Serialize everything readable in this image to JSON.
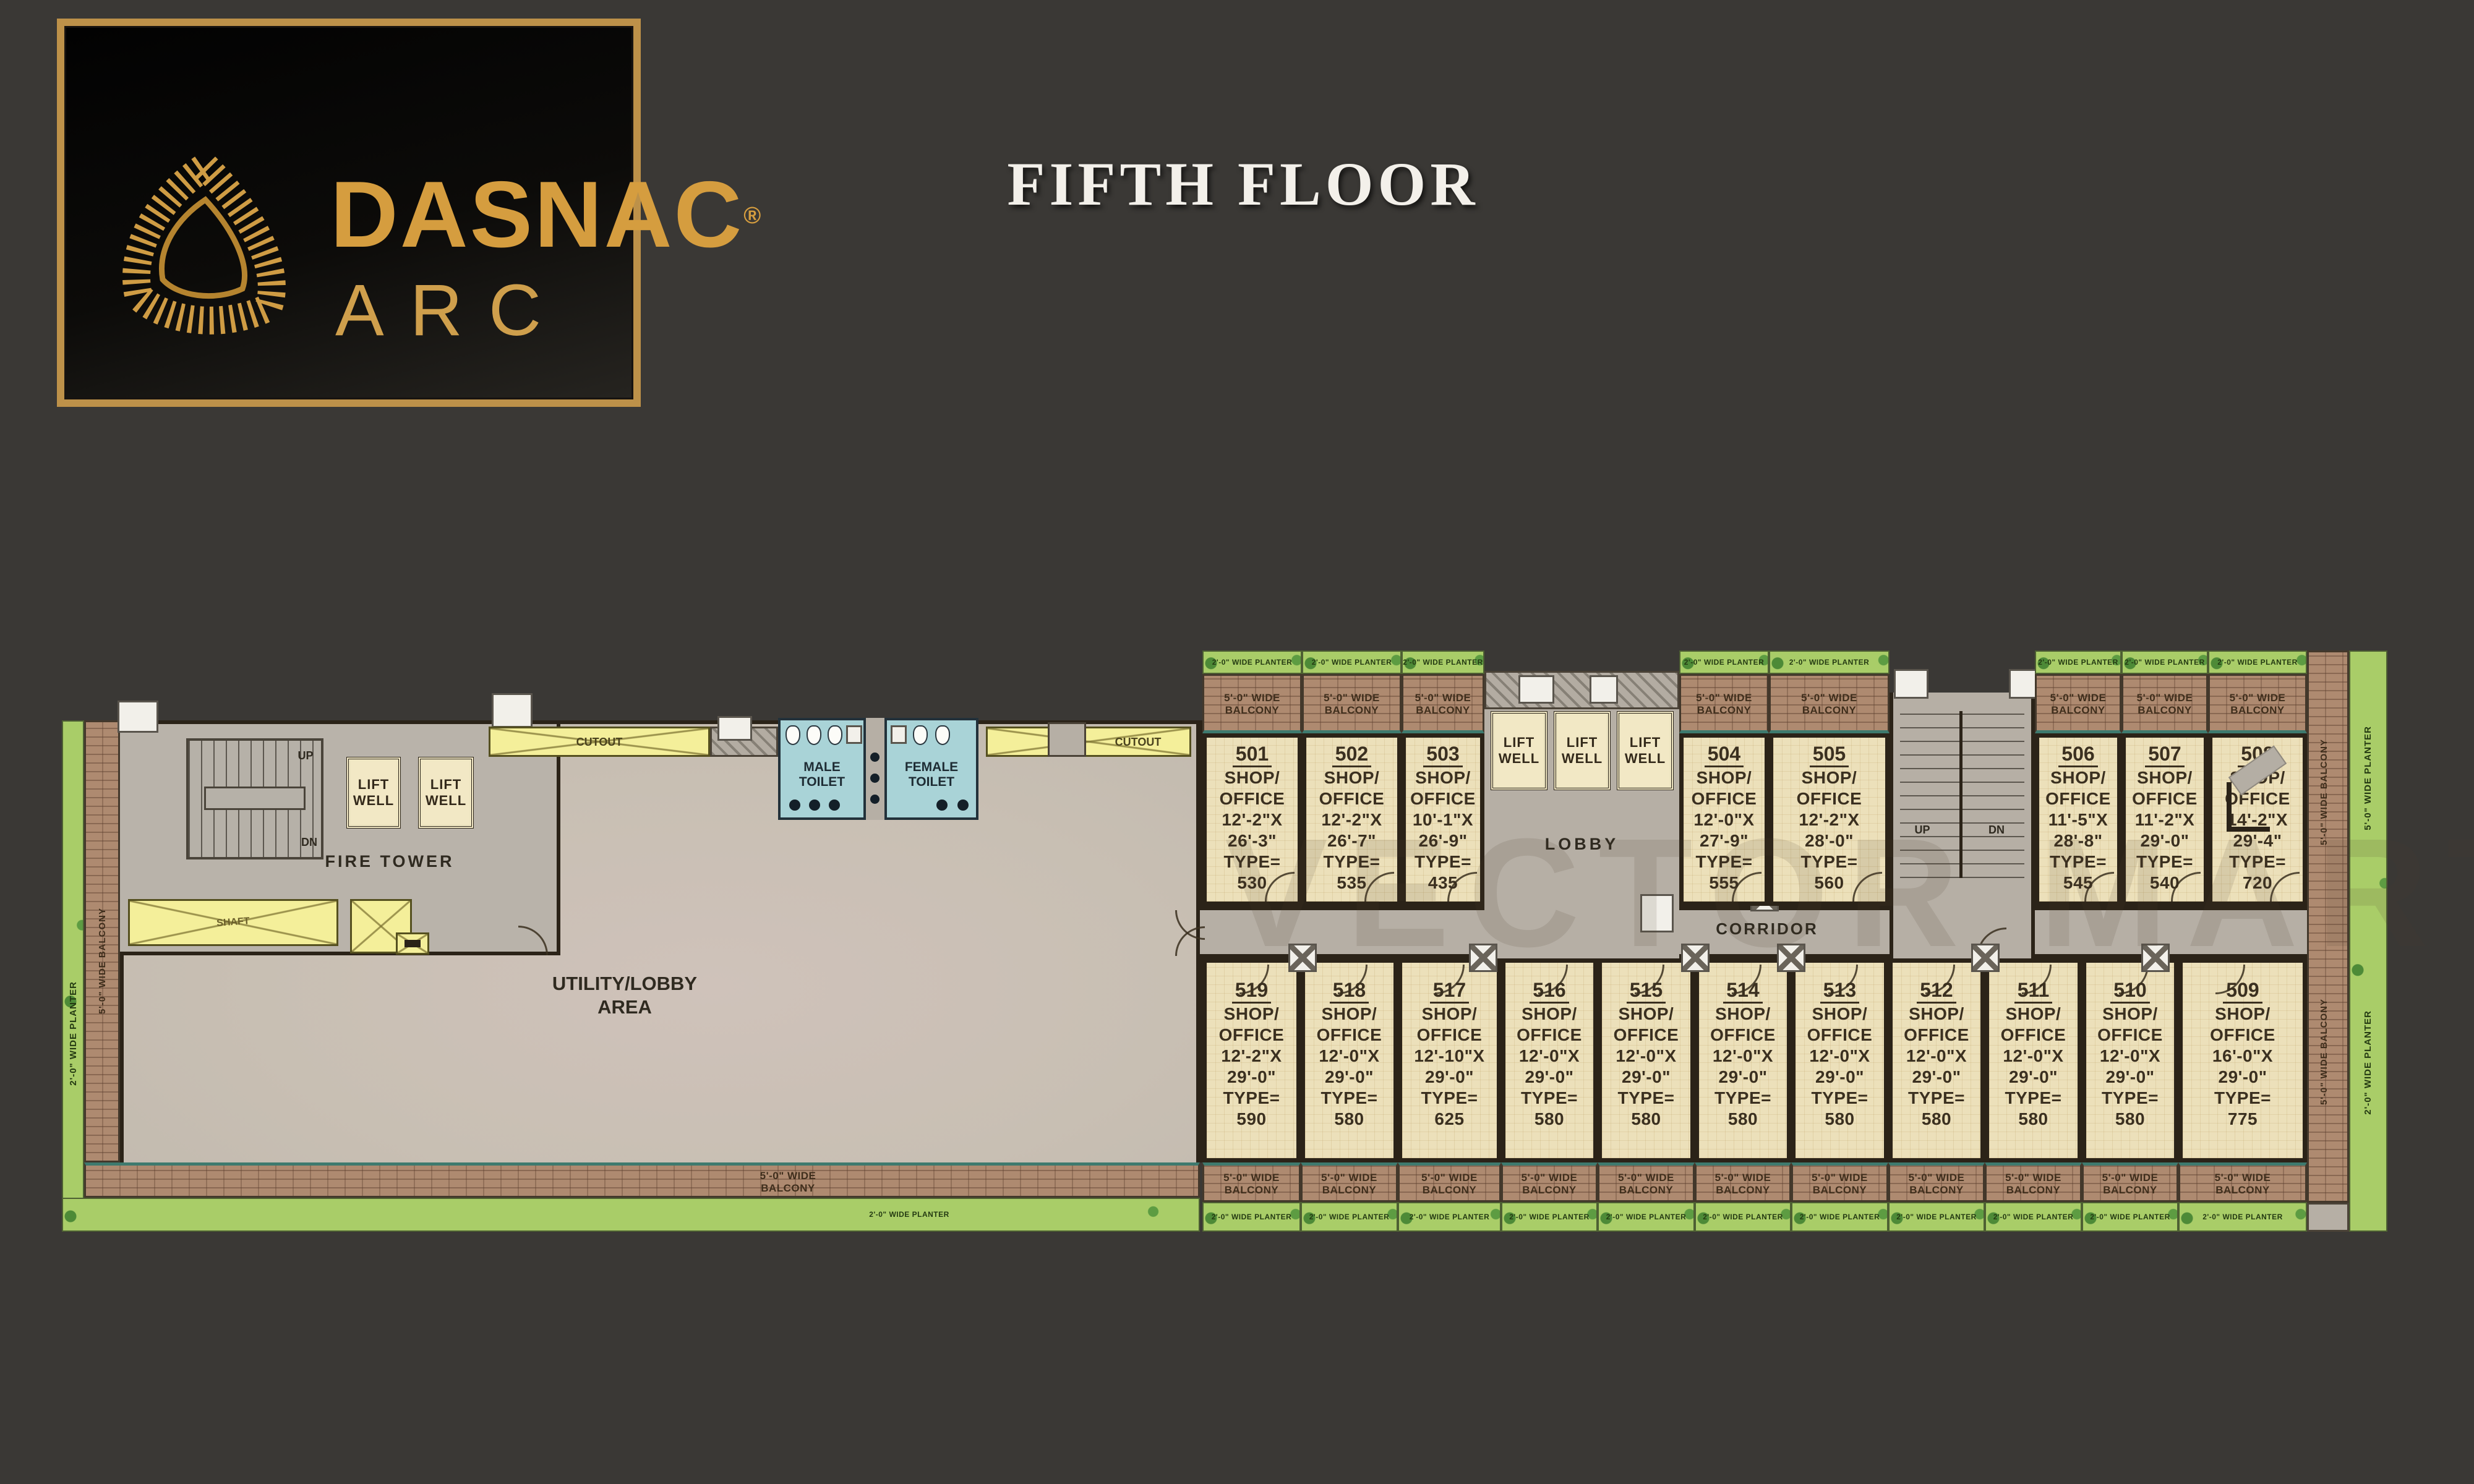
{
  "page": {
    "title": "FIFTH FLOOR"
  },
  "logo": {
    "brand": "DASNAC",
    "reg": "®",
    "sub": "ARC"
  },
  "watermark": "VECTOR MART",
  "labels": {
    "corridor": "CORRIDOR",
    "lobby": "LOBBY",
    "fire_tower": "FIRE TOWER",
    "utility1": "UTILITY/LOBBY",
    "utility2": "AREA",
    "lift1": "LIFT",
    "lift2": "WELL",
    "male1": "MALE",
    "male2": "TOILET",
    "female1": "FEMALE",
    "female2": "TOILET",
    "cutout": "CUTOUT",
    "shaft": "SHAFT",
    "up": "UP",
    "dn": "DN",
    "balcony5_l1": "5'-0\" WIDE",
    "balcony5_l2": "BALCONY",
    "balcony5_vert": "5'-0\" WIDE BALCONY",
    "planter2": "2'-0\" WIDE PLANTER",
    "planter5": "5'-0\" WIDE PLANTER"
  },
  "units": {
    "top": [
      {
        "no": "501",
        "l1": "SHOP/",
        "l2": "OFFICE",
        "d1": "12'-2\"X",
        "d2": "26'-3\"",
        "t": "TYPE=",
        "a": "530"
      },
      {
        "no": "502",
        "l1": "SHOP/",
        "l2": "OFFICE",
        "d1": "12'-2\"X",
        "d2": "26'-7\"",
        "t": "TYPE=",
        "a": "535"
      },
      {
        "no": "503",
        "l1": "SHOP/",
        "l2": "OFFICE",
        "d1": "10'-1\"X",
        "d2": "26'-9\"",
        "t": "TYPE=",
        "a": "435"
      },
      {
        "no": "504",
        "l1": "SHOP/",
        "l2": "OFFICE",
        "d1": "12'-0\"X",
        "d2": "27'-9\"",
        "t": "TYPE=",
        "a": "555"
      },
      {
        "no": "505",
        "l1": "SHOP/",
        "l2": "OFFICE",
        "d1": "12'-2\"X",
        "d2": "28'-0\"",
        "t": "TYPE=",
        "a": "560"
      },
      {
        "no": "506",
        "l1": "SHOP/",
        "l2": "OFFICE",
        "d1": "11'-5\"X",
        "d2": "28'-8\"",
        "t": "TYPE=",
        "a": "545"
      },
      {
        "no": "507",
        "l1": "SHOP/",
        "l2": "OFFICE",
        "d1": "11'-2\"X",
        "d2": "29'-0\"",
        "t": "TYPE=",
        "a": "540"
      },
      {
        "no": "508",
        "l1": "SHOP/",
        "l2": "OFFICE",
        "d1": "14'-2\"X",
        "d2": "29'-4\"",
        "t": "TYPE=",
        "a": "720"
      }
    ],
    "bottom": [
      {
        "no": "519",
        "l1": "SHOP/",
        "l2": "OFFICE",
        "d1": "12'-2\"X",
        "d2": "29'-0\"",
        "t": "TYPE=",
        "a": "590"
      },
      {
        "no": "518",
        "l1": "SHOP/",
        "l2": "OFFICE",
        "d1": "12'-0\"X",
        "d2": "29'-0\"",
        "t": "TYPE=",
        "a": "580"
      },
      {
        "no": "517",
        "l1": "SHOP/",
        "l2": "OFFICE",
        "d1": "12'-10\"X",
        "d2": "29'-0\"",
        "t": "TYPE=",
        "a": "625"
      },
      {
        "no": "516",
        "l1": "SHOP/",
        "l2": "OFFICE",
        "d1": "12'-0\"X",
        "d2": "29'-0\"",
        "t": "TYPE=",
        "a": "580"
      },
      {
        "no": "515",
        "l1": "SHOP/",
        "l2": "OFFICE",
        "d1": "12'-0\"X",
        "d2": "29'-0\"",
        "t": "TYPE=",
        "a": "580"
      },
      {
        "no": "514",
        "l1": "SHOP/",
        "l2": "OFFICE",
        "d1": "12'-0\"X",
        "d2": "29'-0\"",
        "t": "TYPE=",
        "a": "580"
      },
      {
        "no": "513",
        "l1": "SHOP/",
        "l2": "OFFICE",
        "d1": "12'-0\"X",
        "d2": "29'-0\"",
        "t": "TYPE=",
        "a": "580"
      },
      {
        "no": "512",
        "l1": "SHOP/",
        "l2": "OFFICE",
        "d1": "12'-0\"X",
        "d2": "29'-0\"",
        "t": "TYPE=",
        "a": "580"
      },
      {
        "no": "511",
        "l1": "SHOP/",
        "l2": "OFFICE",
        "d1": "12'-0\"X",
        "d2": "29'-0\"",
        "t": "TYPE=",
        "a": "580"
      },
      {
        "no": "510",
        "l1": "SHOP/",
        "l2": "OFFICE",
        "d1": "12'-0\"X",
        "d2": "29'-0\"",
        "t": "TYPE=",
        "a": "580"
      },
      {
        "no": "509",
        "l1": "SHOP/",
        "l2": "OFFICE",
        "d1": "16'-0\"X",
        "d2": "29'-0\"",
        "t": "TYPE=",
        "a": "775"
      }
    ]
  },
  "colors": {
    "background": "#3a3835",
    "gold": "#d59d3f",
    "title": "#f3f0ea",
    "room": "#ece0ba",
    "floor": "#b6afa5",
    "brick": "#ae8a70",
    "planter": "#a9cd68",
    "cutout": "#f4ef9a",
    "toilet": "#a9d3d7",
    "wall": "#2b2318"
  }
}
